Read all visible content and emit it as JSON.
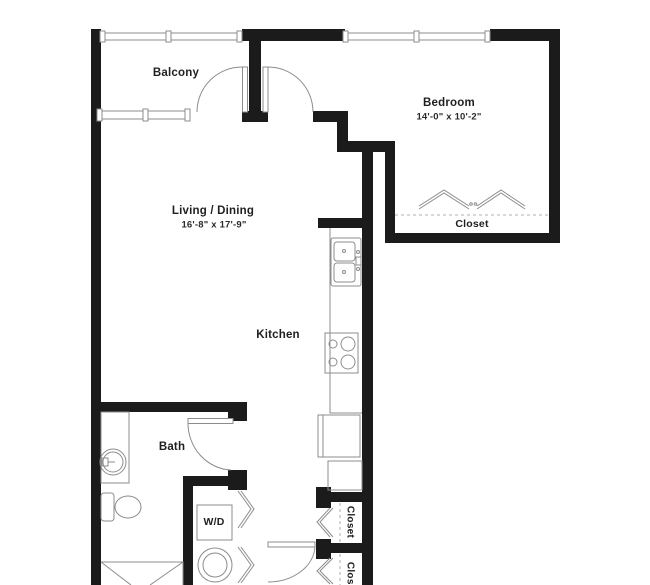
{
  "floorplan": {
    "title": "One-bedroom apartment floor plan",
    "rooms": {
      "balcony": {
        "label": "Balcony"
      },
      "bedroom": {
        "label": "Bedroom",
        "dimensions": "14'-0\" x 10'-2\""
      },
      "living_dining": {
        "label": "Living / Dining",
        "dimensions": "16'-8\" x 17'-9\""
      },
      "kitchen": {
        "label": "Kitchen"
      },
      "bedroom_closet": {
        "label": "Closet"
      },
      "bath": {
        "label": "Bath"
      },
      "washer_dryer": {
        "label": "W/D"
      },
      "hall_closet_1": {
        "label": "Closet"
      },
      "hall_closet_2": {
        "label": "Closet"
      }
    },
    "colors": {
      "wall": "#1b1b1b",
      "thin_line": "#8c8c8c",
      "dashed_line": "#b0b0b0",
      "text": "#1f1f1f",
      "background": "#ffffff"
    }
  }
}
